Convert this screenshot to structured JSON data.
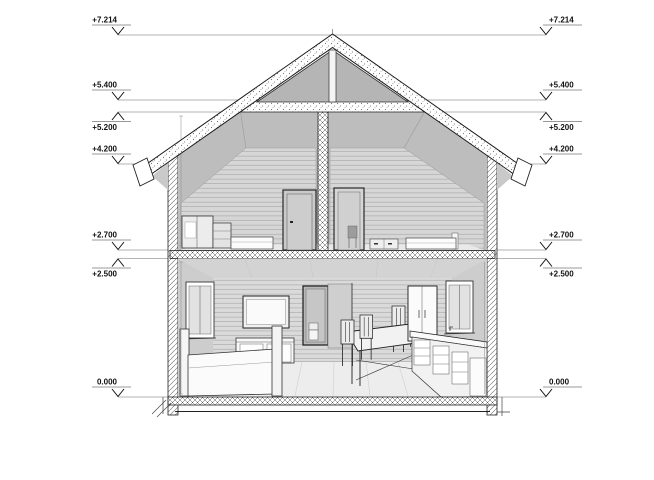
{
  "meta": {
    "drawing_type": "architectural cross-section of a two-story house",
    "style": "monochrome line drawing with hatched cut walls and interior perspective"
  },
  "colors": {
    "background": "#ffffff",
    "ink": "#1f1f1f",
    "dimension_line": "#b3b3b3",
    "wall_fill": "#d6d6d6",
    "ceiling_fill": "#bdbdbd"
  },
  "elevations": {
    "levels": [
      {
        "label": "+7.214",
        "direction": "down",
        "feature": "roof ridge"
      },
      {
        "label": "+5.400",
        "direction": "down",
        "feature": "collar ceiling top"
      },
      {
        "label": "+5.200",
        "direction": "up",
        "feature": "attic ceiling"
      },
      {
        "label": "+4.200",
        "direction": "down",
        "feature": "eaves"
      },
      {
        "label": "+2.700",
        "direction": "down",
        "feature": "attic floor"
      },
      {
        "label": "+2.500",
        "direction": "up",
        "feature": "ground ceiling"
      },
      {
        "label": "0.000",
        "direction": "down",
        "feature": "ground floor"
      }
    ]
  }
}
